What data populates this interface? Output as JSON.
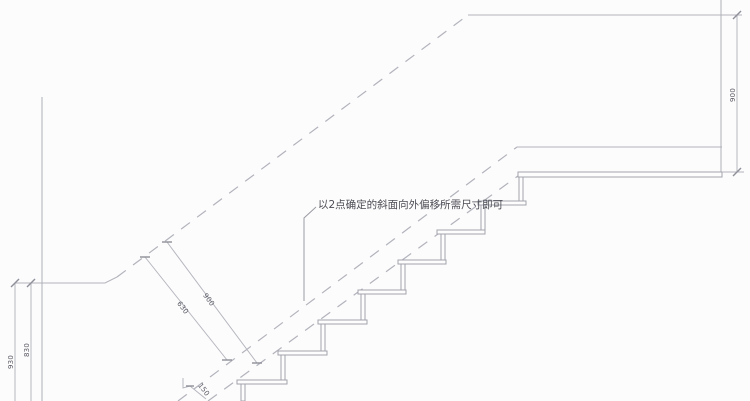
{
  "drawing": {
    "type": "stair-section-cad-drawing",
    "annotation": "以2点确定的斜面向外偏移所需尺寸即可",
    "dimensions": {
      "diag_inner": "630",
      "diag_outer": "900",
      "left_inner": "830",
      "left_outer": "930",
      "right": "900",
      "offset": "150"
    },
    "colors": {
      "background": "#fcfcfc",
      "line_gray": "#b4b5bd",
      "step_gray": "#a2a3ad",
      "text_gray": "#4c4c55"
    },
    "step_count_visible": 8
  }
}
